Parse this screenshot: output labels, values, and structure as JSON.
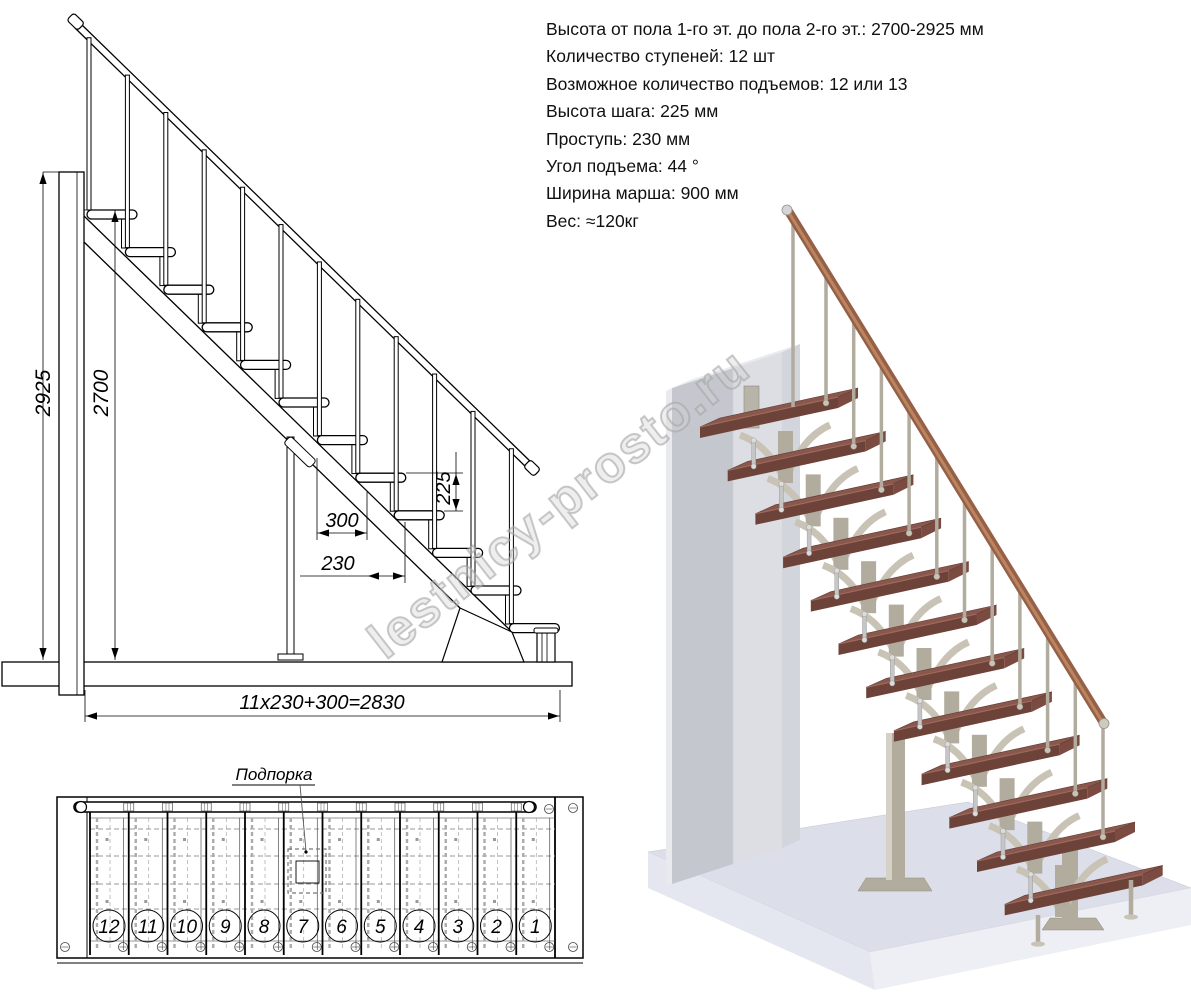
{
  "specs": {
    "lines": [
      "Высота от пола 1-го эт. до пола 2-го эт.: 2700-2925 мм",
      "Количество ступеней: 12 шт",
      "Возможное количество подъемов: 12 или 13",
      "Высота шага: 225 мм",
      "Проступь: 230 мм",
      "Угол подъема: 44 °",
      "Ширина марша: 900 мм",
      "Вес: ≈120кг"
    ]
  },
  "elevation_dims": {
    "total_height": "2925",
    "flight_height": "2700",
    "step_depth": "300",
    "tread_depth": "230",
    "step_rise": "225",
    "total_run": "11x230+300=2830"
  },
  "plan": {
    "support_label": "Подпорка",
    "step_numbers": [
      "12",
      "11",
      "10",
      "9",
      "8",
      "7",
      "6",
      "5",
      "4",
      "3",
      "2",
      "1"
    ]
  },
  "watermark": {
    "text": "lestnicy-prosto.ru"
  },
  "colors": {
    "line": "#000000",
    "dash_grey": "#9a9a9a",
    "tread_top": "#8a574d",
    "tread_front": "#6d4239",
    "tread_side": "#7b4a41",
    "metal": "#c9c3b6",
    "metal_dark": "#b2ac9f",
    "silver": "#c6c6c6",
    "rail_wood": "#966046",
    "rail_light": "#c08a65",
    "wall_light": "#dcdee3",
    "wall_dark": "#c5c7cf",
    "wall_top": "#e8eaee",
    "platform_top": "#dcdfe9",
    "platform_front": "#edeff5",
    "platform_left": "#e4e7ef",
    "watermark_grey": "#bfbfbf"
  }
}
